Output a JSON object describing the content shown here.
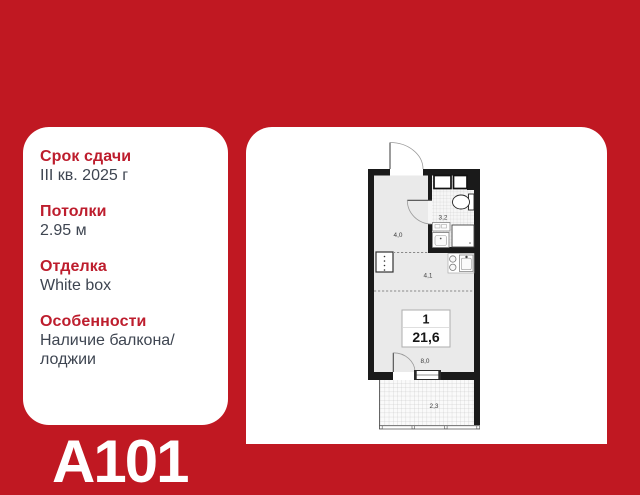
{
  "colors": {
    "background_red": "#c01822",
    "heading_red": "#bd1d2d",
    "body_text": "#3e4551",
    "wall_black": "#1a1a1a",
    "floor_gray": "#eaeaea"
  },
  "info_panel": {
    "items": [
      {
        "label": "Срок сдачи",
        "value": "III кв. 2025 г"
      },
      {
        "label": "Потолки",
        "value": "2.95 м"
      },
      {
        "label": "Отделка",
        "value": "White box"
      },
      {
        "label": "Особенности",
        "value": "Наличие балкона/лоджии"
      }
    ]
  },
  "brand": {
    "logo_text": "A101"
  },
  "floor_plan": {
    "badge": {
      "unit_type": "1",
      "area_total": "21,6"
    },
    "areas": {
      "hallway": "4,0",
      "bathroom": "3,2",
      "kitchen": "4,1",
      "living": "8,0",
      "balcony": "2,3"
    }
  }
}
